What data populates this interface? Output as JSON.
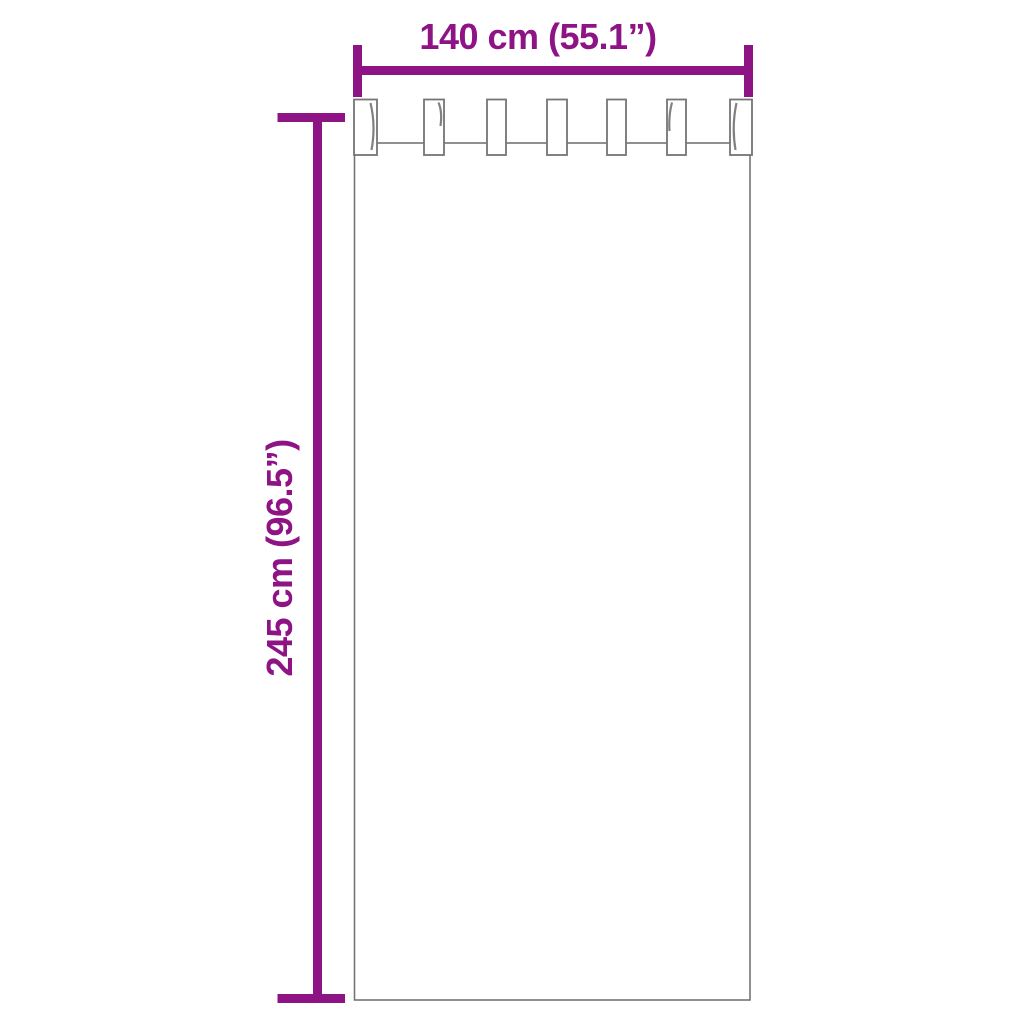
{
  "diagram": {
    "background_color": "#ffffff",
    "accent_color": "#8e1384",
    "outline_color": "#757575",
    "curtain": {
      "type": "tab-top-curtain-outline",
      "tab_count": 7
    },
    "width_dimension": {
      "label": "140 cm (55.1”)",
      "value_cm": 140,
      "value_inch": 55.1
    },
    "height_dimension": {
      "label": "245 cm (96.5”)",
      "value_cm": 245,
      "value_inch": 96.5
    }
  }
}
